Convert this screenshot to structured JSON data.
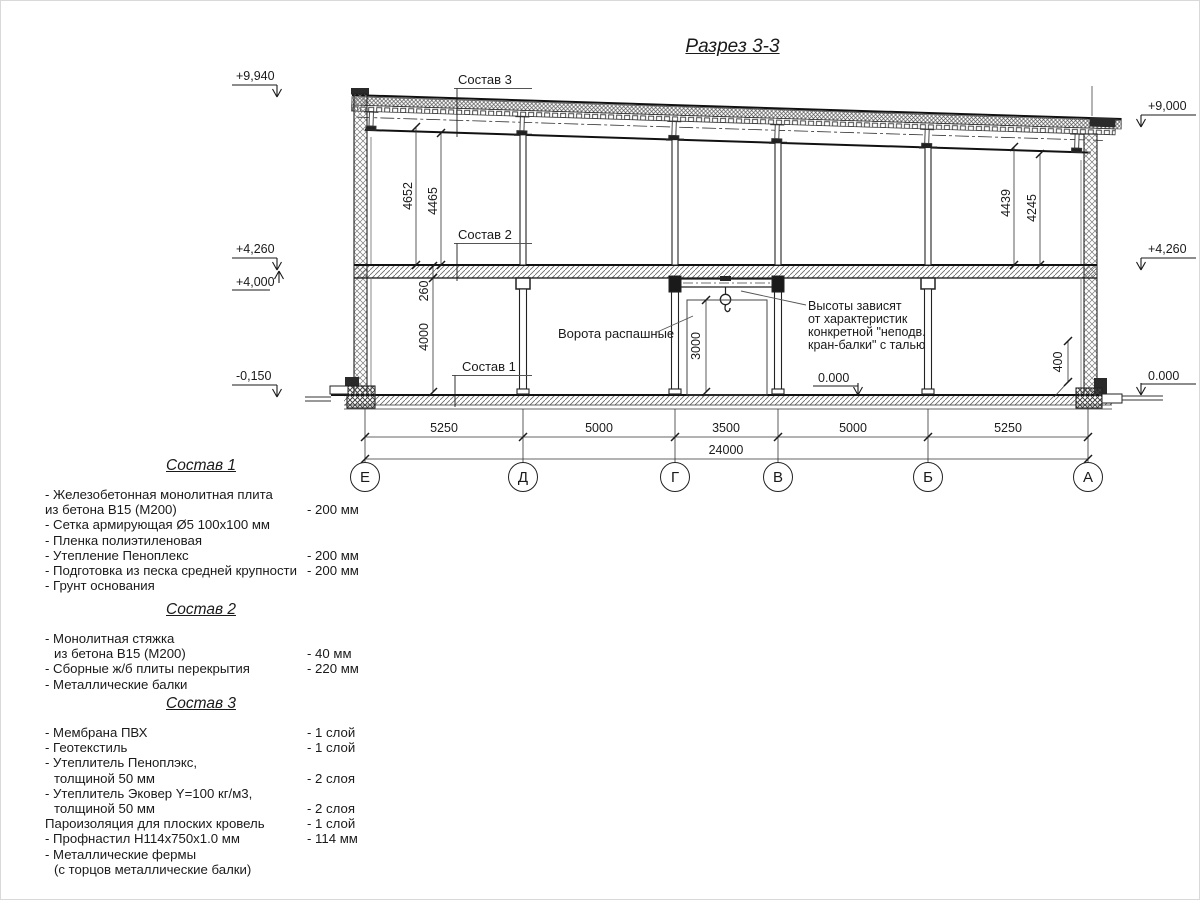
{
  "page": {
    "title": "Разрез 3-3"
  },
  "drawing": {
    "elevation_marks": {
      "top_left": "+9,940",
      "top_right": "+9,000",
      "mid_left_upper": "+4,260",
      "mid_left_lower": "+4,000",
      "mid_right": "+4,260",
      "bottom_left": "-0,150",
      "bottom_mid": "0.000",
      "bottom_right": "0.000"
    },
    "callouts": {
      "sostav3": "Состав 3",
      "sostav2": "Состав 2",
      "sostav1": "Состав 1",
      "gate": "Ворота распашные",
      "crane_note": [
        "Высоты зависят",
        "от характеристик",
        "конкретной \"неподв.",
        "кран-балки\" с талью"
      ]
    },
    "vertical_dims": {
      "upper_left_outer": "4652",
      "upper_left_inner": "4465",
      "upper_right_outer": "4439",
      "upper_right_inner": "4245",
      "floor_package": "260",
      "lower_storey": "4000",
      "gate_height": "3000",
      "plinth": "400"
    },
    "axes": [
      "Е",
      "Д",
      "Г",
      "В",
      "Б",
      "А"
    ],
    "span_dims": [
      "5250",
      "5000",
      "3500",
      "5000",
      "5250"
    ],
    "total_dim": "24000"
  },
  "compositions": [
    {
      "heading": "Состав 1",
      "rows": [
        {
          "text": "- Железобетонная  монолитная плита",
          "value": ""
        },
        {
          "text": "из бетона  В15 (М200)",
          "value": "- 200 мм"
        },
        {
          "text": "- Сетка армирующая Ø5 100х100 мм",
          "value": ""
        },
        {
          "text": "- Пленка полиэтиленовая",
          "value": ""
        },
        {
          "text": "- Утепление Пеноплекс",
          "value": "- 200 мм"
        },
        {
          "text": "- Подготовка из песка средней  крупности",
          "value": "- 200 мм"
        },
        {
          "text": "- Грунт основания",
          "value": ""
        }
      ]
    },
    {
      "heading": "Состав 2",
      "rows": [
        {
          "text": "- Монолитная стяжка",
          "value": ""
        },
        {
          "text": "из бетона В15 (М200)",
          "value": "- 40 мм"
        },
        {
          "text": "- Сборные ж/б плиты перекрытия",
          "value": "- 220 мм"
        },
        {
          "text": "- Металлические балки",
          "value": ""
        }
      ]
    },
    {
      "heading": "Состав 3",
      "rows": [
        {
          "text": "- Мембрана ПВХ",
          "value": "- 1 слой"
        },
        {
          "text": "- Геотекстиль",
          "value": "- 1 слой"
        },
        {
          "text": "- Утеплитель Пеноплэкс,",
          "value": ""
        },
        {
          "text": "толщиной 50 мм",
          "value": "- 2 слоя"
        },
        {
          "text": "- Утеплитель Эковер Y=100 кг/м3,",
          "value": ""
        },
        {
          "text": "толщиной 50 мм",
          "value": "- 2 слоя"
        },
        {
          "text": "Пароизоляция для плоских кровель",
          "value": "- 1 слой"
        },
        {
          "text": "- Профнастил Н114х750х1.0 мм",
          "value": "- 114 мм"
        },
        {
          "text": "- Металлические фермы",
          "value": ""
        },
        {
          "text": "(с торцов металлические балки)",
          "value": ""
        }
      ]
    }
  ]
}
